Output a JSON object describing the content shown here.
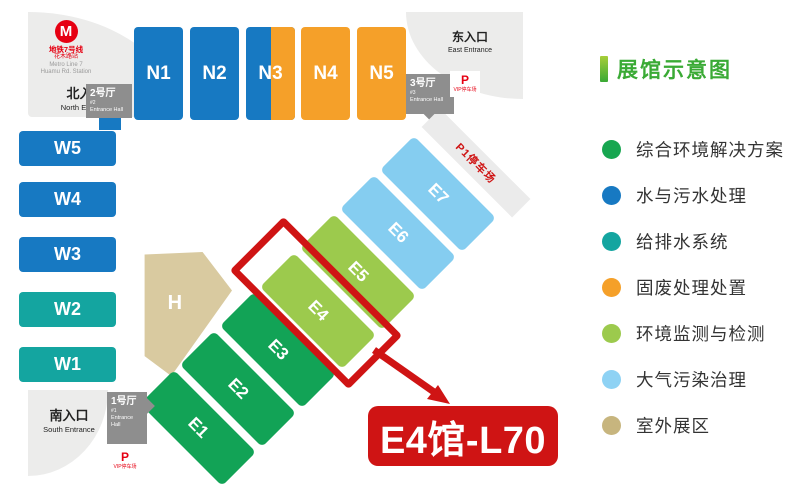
{
  "map": {
    "metro": {
      "line_zh": "地铁7号线",
      "station_zh": "花木路站",
      "line_en": "Metro Line 7",
      "station_en": "Huamu Rd. Station",
      "logo_letter": "M"
    },
    "entrances": {
      "north": {
        "zh": "北入口",
        "en": "North Entrance"
      },
      "east": {
        "zh": "东入口",
        "en": "East Entrance"
      },
      "south": {
        "zh": "南入口",
        "en": "South Entrance"
      }
    },
    "entrance_halls": {
      "hall1": {
        "zh": "1号厅",
        "num": "#1",
        "en": "Entrance Hall"
      },
      "hall2": {
        "zh": "2号厅",
        "num": "#2",
        "en": "Entrance Hall"
      },
      "hall3": {
        "zh": "3号厅",
        "num": "#3",
        "en": "Entrance Hall"
      }
    },
    "parking": {
      "p": "P",
      "vip": "VIP停车场",
      "p1": "P1停车场"
    },
    "halls": {
      "north": [
        "N1",
        "N2",
        "N3",
        "N4",
        "N5"
      ],
      "west": [
        "W5",
        "W4",
        "W3",
        "W2",
        "W1"
      ],
      "east": [
        "E1",
        "E2",
        "E3",
        "E4",
        "E5",
        "E6",
        "E7"
      ],
      "central": "H"
    },
    "callout": {
      "label": "E4馆-L70",
      "highlighted_hall": "E4"
    }
  },
  "legend": {
    "title": "展馆示意图",
    "items": [
      {
        "label": "综合环境解决方案",
        "color": "#17a650"
      },
      {
        "label": "水与污水处理",
        "color": "#1779c2"
      },
      {
        "label": "给排水系统",
        "color": "#14a5a0"
      },
      {
        "label": "固废处理处置",
        "color": "#f5a029"
      },
      {
        "label": "环境监测与检测",
        "color": "#9cca4d"
      },
      {
        "label": "大气污染治理",
        "color": "#8ed2f4"
      },
      {
        "label": "室外展区",
        "color": "#c7b57e"
      }
    ]
  },
  "colors": {
    "blue": "#1779c2",
    "teal": "#14a5a0",
    "orange": "#f5a029",
    "green": "#12a356",
    "lightGreen": "#9cca4d",
    "lightBlue": "#85cdf0",
    "tan": "#d9caa0",
    "red": "#cf1414",
    "metroRed": "#e60012",
    "gray": "#8e8e8e",
    "titleGreen": "#3aaa35"
  }
}
